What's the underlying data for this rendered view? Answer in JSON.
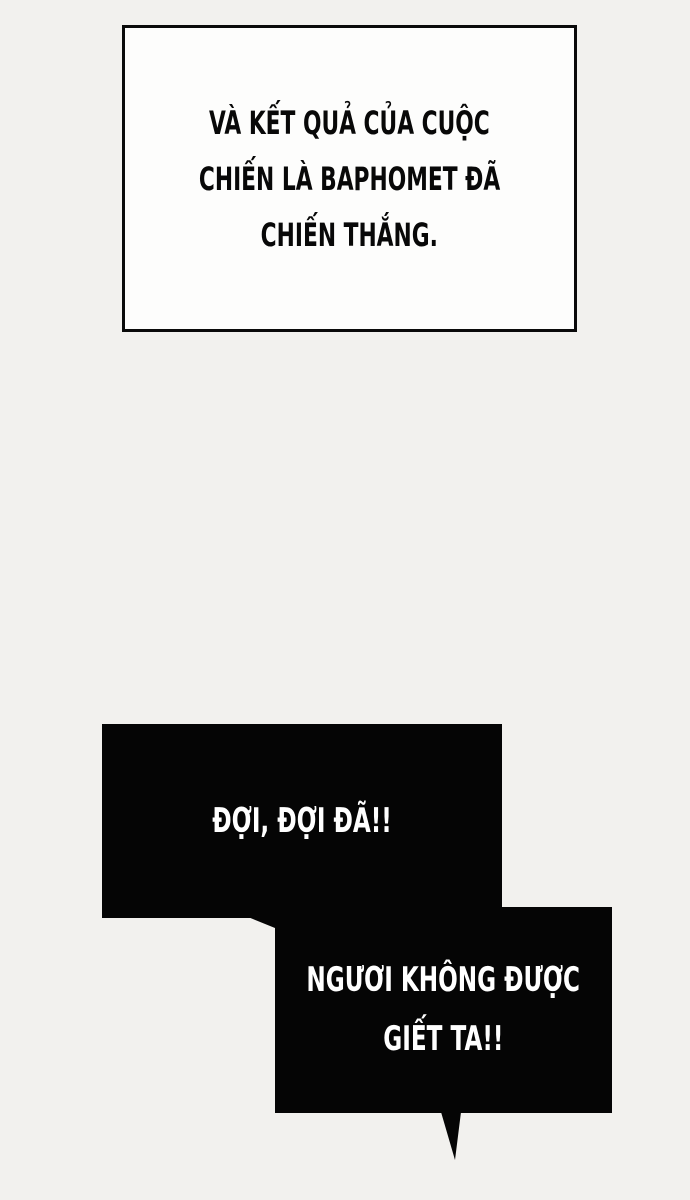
{
  "panel": {
    "background_color": "#f2f1ee",
    "ink_color": "#080808",
    "bubble_color": "#050505",
    "bubble_text_color": "#ffffff"
  },
  "narration": {
    "lines": [
      "VÀ KẾT QUẢ CỦA CUỘC",
      "CHIẾN LÀ BAPHOMET ĐÃ",
      "CHIẾN THẮNG."
    ]
  },
  "bubbles": [
    {
      "style": "black-box",
      "has_tail": false,
      "lines": [
        "ĐỢI, ĐỢI ĐÃ!!"
      ]
    },
    {
      "style": "black-box",
      "has_tail": true,
      "lines": [
        "NGƯƠI KHÔNG ĐƯỢC",
        "GIẾT TA!!"
      ]
    }
  ]
}
